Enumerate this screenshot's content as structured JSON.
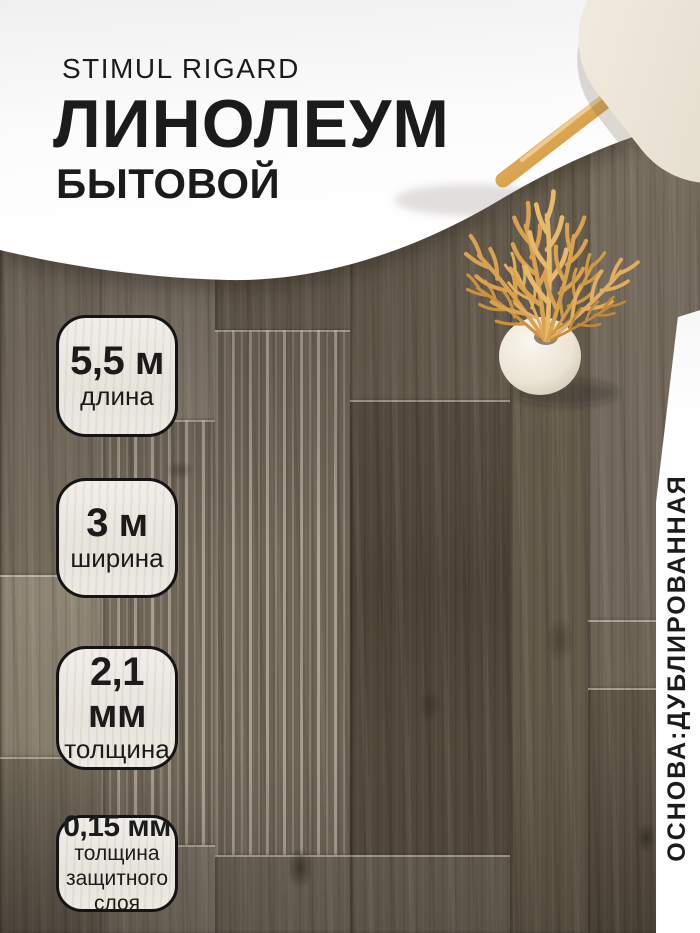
{
  "header": {
    "brand": "STIMUL RIGARD",
    "title": "ЛИНОЛЕУМ",
    "subtitle": "БЫТОВОЙ"
  },
  "badges": [
    {
      "value": "5,5 м",
      "lines": [
        "длина"
      ]
    },
    {
      "value": "3 м",
      "lines": [
        "ширина"
      ]
    },
    {
      "value": "2,1 мм",
      "lines": [
        "толщина"
      ]
    },
    {
      "value": "0,15 мм",
      "lines": [
        "толщина",
        "защитного",
        "слоя"
      ]
    }
  ],
  "side_banner": {
    "text": "ОСНОВА:ДУБЛИРОВАННАЯ"
  },
  "colors": {
    "text": "#1b1b1b",
    "badge-border": "#141414",
    "badge-bg": "#eceae4",
    "banner-bg": "#ffffff",
    "wheat-gold": "#d9a251",
    "wood-leg": "#dba351",
    "seat": "#e9e2d4",
    "floor-base": "#6e6456"
  }
}
